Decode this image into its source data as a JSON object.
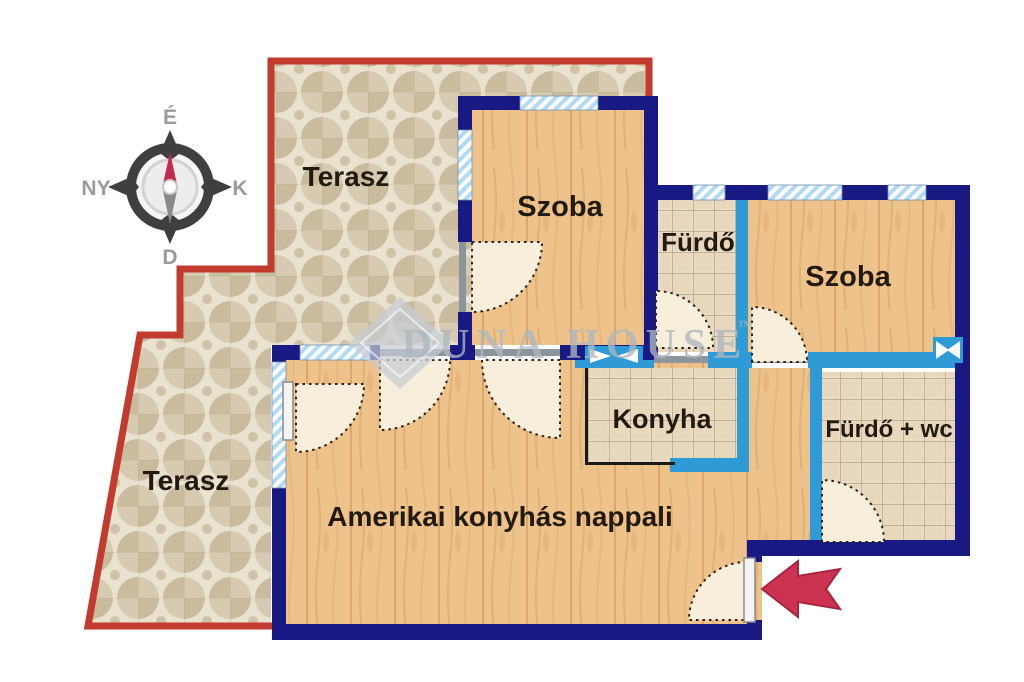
{
  "compass": {
    "north": "É",
    "east": "K",
    "south": "D",
    "west": "NY"
  },
  "rooms": {
    "terrace_top": {
      "label": "Terasz"
    },
    "terrace_left": {
      "label": "Terasz"
    },
    "bedroom1": {
      "label": "Szoba"
    },
    "bedroom2": {
      "label": "Szoba"
    },
    "bathroom1": {
      "label": "Fürdő"
    },
    "bathroom2": {
      "label": "Fürdő + wc"
    },
    "kitchen": {
      "label": "Konyha"
    },
    "living_room": {
      "label": "Amerikai konyhás nappali"
    }
  },
  "watermark": {
    "text": "DUNA HOUSE",
    "tm": "™"
  },
  "colors": {
    "exterior_wall": "#191984",
    "interior_wall": "#2e9bd6",
    "terrace_border": "#c23b2e",
    "entrance_arrow": "#cb3350",
    "wood_floor": "#eec38b",
    "tile_floor": "#eadcc3",
    "terrace_tile": "#e9e2cf",
    "window_hatch": "#b3daf3"
  }
}
